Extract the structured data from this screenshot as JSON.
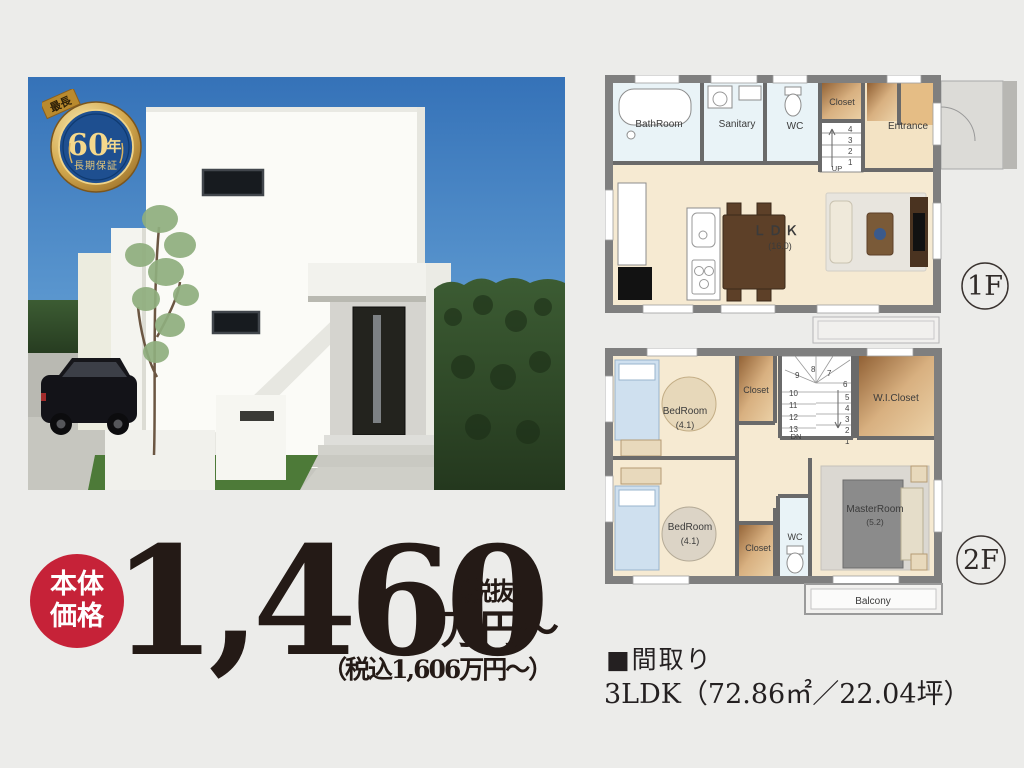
{
  "colors": {
    "background": "#ececea",
    "price_text": "#241a16",
    "accent_red": "#c62238",
    "badge_gold": "#c99f48",
    "badge_blue": "#1e4f90",
    "plan_wall": "#7f7f7f",
    "plan_floor": "#f6ead2",
    "sky_blue": "#3d7fc4"
  },
  "badge": {
    "ribbon": "最長",
    "years_number": "60",
    "years_unit": "年",
    "subtitle": "長期保証"
  },
  "price": {
    "label_top": "本体",
    "label_bottom": "価格",
    "amount": "1,460",
    "tax_excluded": "（税抜）",
    "unit": "万円〜",
    "tax_included": "（税込1,606万円〜）"
  },
  "plan1f": {
    "floor_label": "1F",
    "bathroom": "BathRoom",
    "sanitary": "Sanitary",
    "wc": "WC",
    "closet": "Closet",
    "entrance": "Entrance",
    "ldk": "ＬＤＫ",
    "ldk_size": "(16.0)",
    "up": "UP",
    "stairs": [
      "4",
      "3",
      "2",
      "1"
    ]
  },
  "plan2f": {
    "floor_label": "2F",
    "bedroom1": "BedRoom",
    "bedroom1_size": "(4.1)",
    "bedroom2": "BedRoom",
    "bedroom2_size": "(4.1)",
    "closet1": "Closet",
    "closet2": "Closet",
    "wic": "W.I.Closet",
    "wc": "WC",
    "master": "MasterRoom",
    "master_size": "(5.2)",
    "balcony": "Balcony",
    "dn": "DN",
    "stairs_left": [
      "10",
      "11",
      "12",
      "13"
    ],
    "stairs_top": [
      "9",
      "8",
      "7"
    ],
    "stairs_right": [
      "6",
      "5",
      "4",
      "3",
      "2",
      "1"
    ]
  },
  "details": {
    "heading": "■間取り",
    "spec": "3LDK（72.86㎡／22.04坪）"
  }
}
